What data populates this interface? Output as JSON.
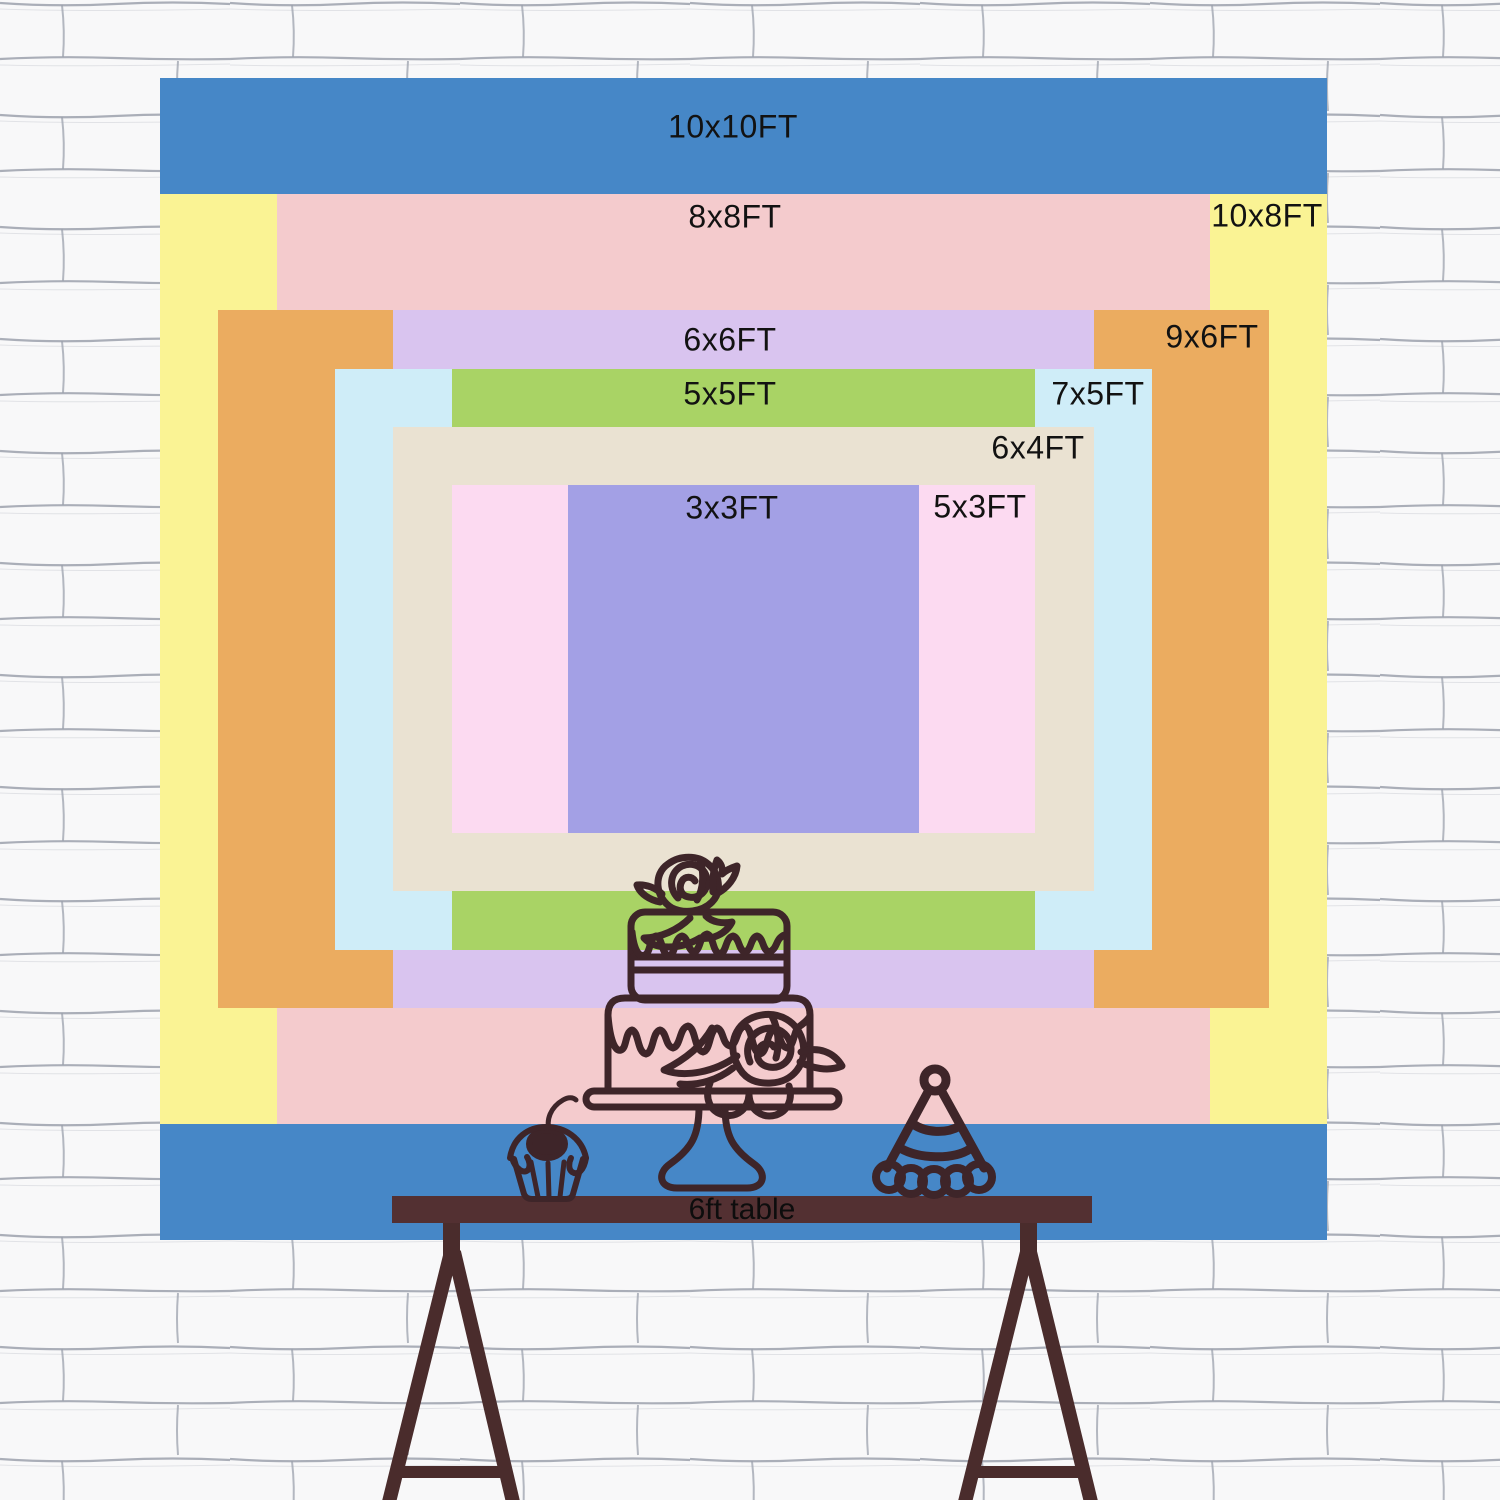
{
  "colors": {
    "wall_bg": "#f8f8f9",
    "wall_line": "#9ca1ad",
    "line_art": "#3E2529",
    "table_bar": "#533032",
    "table_legs": "#4A2C2C",
    "label_text": "#121212"
  },
  "chart_data": {
    "type": "nested-rectangles-size-chart",
    "title": "Backdrop size comparison chart",
    "unit": "FT",
    "backdrop_px": {
      "left": 160,
      "top": 78,
      "width": 1167,
      "height": 1162
    },
    "px_per_ft": {
      "x": 116.7,
      "y": 116.2
    },
    "sizes": [
      {
        "label": "10x10FT",
        "w_ft": 10,
        "h_ft": 10,
        "color": "#4687C7",
        "label_x": 733,
        "label_y": 127
      },
      {
        "label": "10x8FT",
        "w_ft": 10,
        "h_ft": 8,
        "color": "#FAF394",
        "label_x": 1267,
        "label_y": 216
      },
      {
        "label": "8x8FT",
        "w_ft": 8,
        "h_ft": 8,
        "color": "#F4CBCD",
        "label_x": 735,
        "label_y": 217
      },
      {
        "label": "9x6FT",
        "w_ft": 9,
        "h_ft": 6,
        "color": "#EBAC60",
        "label_x": 1212,
        "label_y": 337
      },
      {
        "label": "6x6FT",
        "w_ft": 6,
        "h_ft": 6,
        "color": "#D9C4EF",
        "label_x": 730,
        "label_y": 340
      },
      {
        "label": "7x5FT",
        "w_ft": 7,
        "h_ft": 5,
        "color": "#CFEDF8",
        "label_x": 1098,
        "label_y": 394
      },
      {
        "label": "5x5FT",
        "w_ft": 5,
        "h_ft": 5,
        "color": "#A9D365",
        "label_x": 730,
        "label_y": 394
      },
      {
        "label": "6x4FT",
        "w_ft": 6,
        "h_ft": 4,
        "color": "#EAE2D2",
        "label_x": 1038,
        "label_y": 448
      },
      {
        "label": "5x3FT",
        "w_ft": 5,
        "h_ft": 3,
        "color": "#FCDAF1",
        "label_x": 980,
        "label_y": 507
      },
      {
        "label": "3x3FT",
        "w_ft": 3,
        "h_ft": 3,
        "color": "#A3A0E5",
        "label_x": 732,
        "label_y": 508
      }
    ],
    "table": {
      "label": "6ft table",
      "label_x": 742,
      "label_y": 1210
    }
  }
}
